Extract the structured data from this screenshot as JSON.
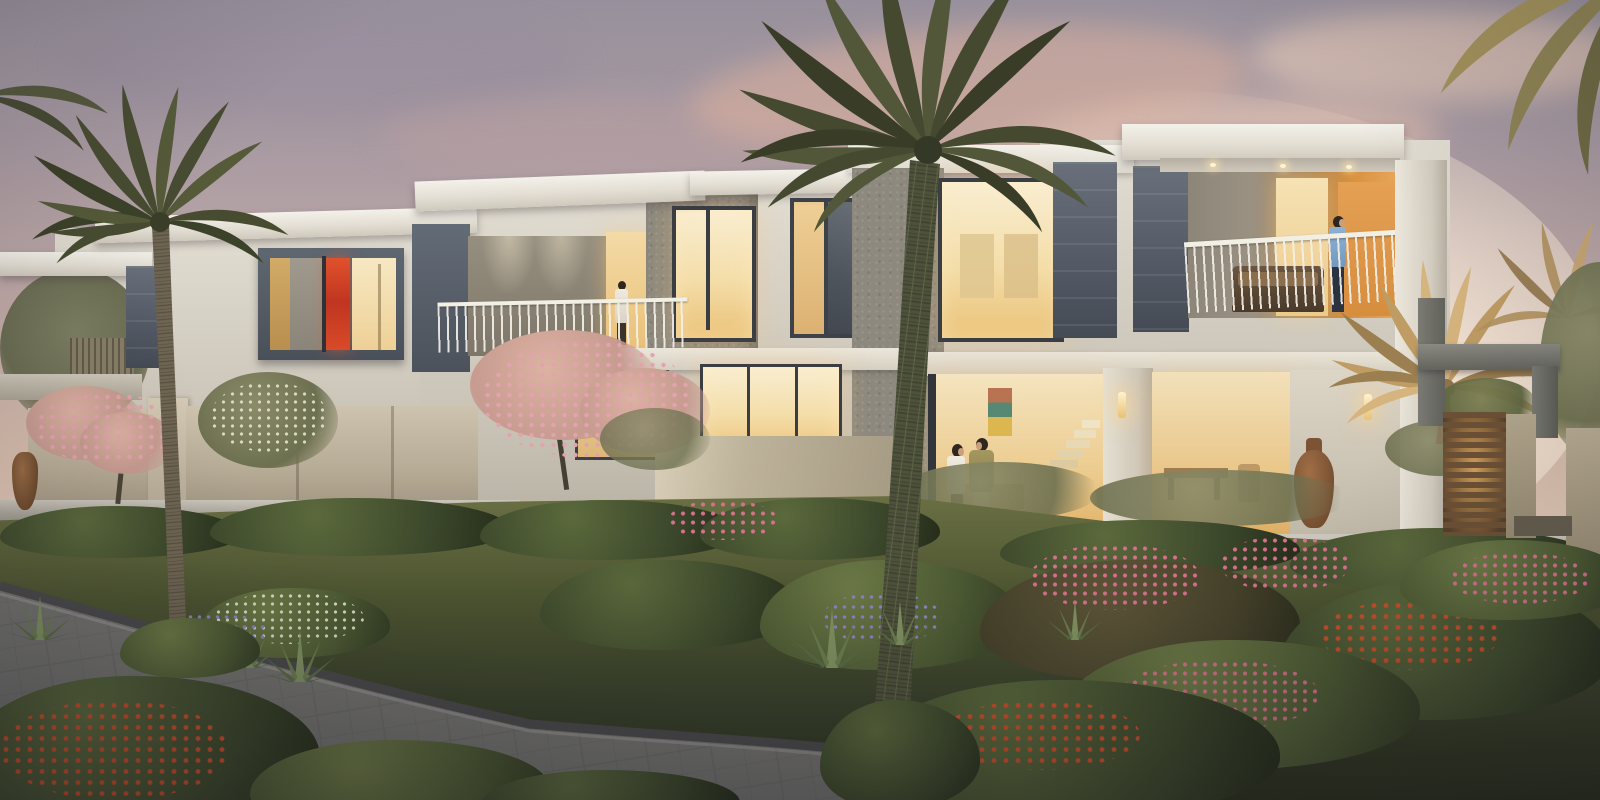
{
  "scene": {
    "type": "photorealistic architectural exterior rendering",
    "time_of_day": "dusk",
    "subject": "Row of modern two-storey townhouses with warmly lit interiors, landscaped flowering garden, palm trees and a curved grey paved walkway",
    "sky": "mauve-grey fading to warm peach with soft pink clouds, brightest at the right horizon"
  },
  "palette": {
    "sky_top": "#97909c",
    "sky_horizon": "#f4e8d8",
    "cloud_pink": "#deb09c",
    "facade_white": "#e2ddd2",
    "roof_slab": "#f3f1ea",
    "concrete_grey": "#8d897e",
    "slate_panel": "#565d68",
    "window_glow": "#f4dda8",
    "window_frame": "#3a3d42",
    "balcony_back_orange": "#d8913f",
    "garden_wall_beige": "#b7ac96",
    "planter_wall": "#aaa69b",
    "grass": "#4c5430",
    "foliage_dark": "#3c482b",
    "flower_pink": "#d4718b",
    "flower_red_orange": "#c8502a",
    "flower_purple": "#8d82c4",
    "palm_green": "#474c31",
    "palm_gold": "#bf9c64",
    "trunk": "#5c5744",
    "path_grey": "#72716f",
    "urn_clay": "#8a5f3e",
    "gate_wood": "#6b5136",
    "gate_backlight": "#d9a85e"
  },
  "elements": {
    "buildings": {
      "description": "continuous row of flat-roofed white townhouses with grey textured volumes and dark slate accent panels",
      "units": [
        {
          "name": "far-left-terrace",
          "features": "low roof slab, reed privacy screen, misty trees"
        },
        {
          "name": "left-unit",
          "features": "projecting slate window box with red artwork and warm lit panes"
        },
        {
          "name": "balcony-unit",
          "features": "recessed balcony, white railing, woman in white at lit doorway"
        },
        {
          "name": "middle-unit",
          "features": "grey textured volume with tall warm window, dark mullioned window"
        },
        {
          "name": "tall-window-unit",
          "features": "double-height warm window beside slate panel, palm in front"
        },
        {
          "name": "right-unit",
          "features": "wide roof slab with soffit downlights, balcony with man in blue shirt, orange feature wall, wicker sofa"
        },
        {
          "name": "entrance",
          "features": "grey pergola frame, timber slat gate backlit by golden light, beige walls"
        }
      ]
    },
    "people": [
      {
        "name": "woman-on-left-balcony",
        "description": "woman in a long white dress standing at the balcony railing by a lit doorway"
      },
      {
        "name": "man-on-right-balcony",
        "description": "man in a light blue shirt and dark trousers leaning on the white balcony railing"
      },
      {
        "name": "woman-walking",
        "description": "woman in a white blouse and dark trousers strolling through the garden"
      },
      {
        "name": "man-walking",
        "description": "man in an olive sweater and beige trousers walking beside her"
      }
    ],
    "vegetation": {
      "palms": [
        {
          "name": "left-green-palm",
          "position": "left, crown overlapping the left unit"
        },
        {
          "name": "central-tall-palm",
          "position": "centre, crown at top edge, trunk running full height of image"
        },
        {
          "name": "right-golden-palms",
          "position": "right of the entrance gate, lit gold by the low sun"
        },
        {
          "name": "corner-fronds",
          "position": "drooping fronds entering from the top-right corner"
        }
      ],
      "trees": [
        "pink flowering tree by the left garden wall",
        "silver-green frangipani behind the left wall",
        "pink flowering tree in front of the centre balcony"
      ],
      "garden": "terraced beds of shrubs with pink, red-orange and purple flowers, agaves, lawn, hedges along beige walls"
    },
    "objects": {
      "urns": [
        "small clay urn at far left wall",
        "tall clay urn beside the right glass wall"
      ],
      "patio_set": "timber table and chairs behind the left garden wall",
      "wicker_sofa": "dark wicker sofa with cushions on the right balcony",
      "wall_sconces": "two glowing cylindrical sconces on the ground-floor walls",
      "gate": "horizontal timber slat gate with warm light glowing through the gaps",
      "walkway": "curved grey stone-paved path with dark edging, lower left"
    },
    "interior": {
      "visible": "warm cream interiors, white staircase behind right glass wall, colourful artwork, dining furniture silhouettes"
    }
  }
}
